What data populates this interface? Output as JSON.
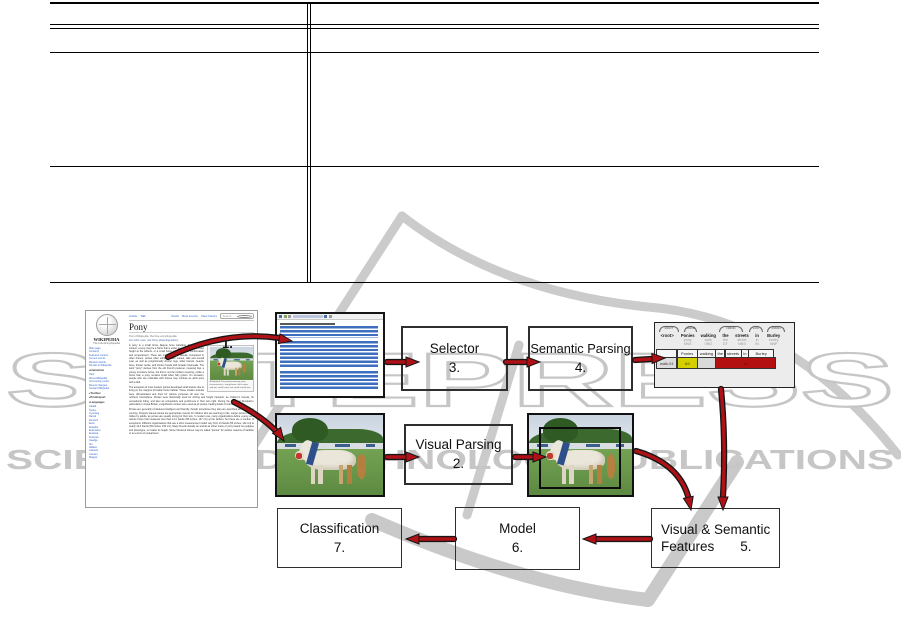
{
  "watermark": {
    "brand": "SCITEPRESS",
    "tagline": "SCIENCE AND TECHNOLOGY PUBLICATIONS"
  },
  "figure": {
    "step1_label": "1.",
    "boxes": {
      "selector": {
        "label": "Selector",
        "num": "3."
      },
      "semantic": {
        "label": "Semantic Parsing",
        "num": "4."
      },
      "visual": {
        "label": "Visual Parsing",
        "num": "2."
      },
      "features": {
        "line1": "Visual & Semantic",
        "line2": "Features",
        "num": "5."
      },
      "model": {
        "label": "Model",
        "num": "6."
      },
      "classification": {
        "label": "Classification",
        "num": "7."
      }
    },
    "wikipedia": {
      "wordmark": "WIKIPEDIA",
      "tagline": "The Free Encyclopedia",
      "tabs_left": [
        "Article",
        "Talk"
      ],
      "tabs_right": [
        "Read",
        "View source",
        "View history"
      ],
      "search": "Search",
      "title": "Pony",
      "from_line": "From Wikipedia, the free encyclopedia",
      "hatnote": "For other uses, see Pony (disambiguation).",
      "sidebar": {
        "group1": [
          "Main page",
          "Contents",
          "Featured content",
          "Current events",
          "Random article",
          "Donate to Wikipedia"
        ],
        "h_interaction": "Interaction",
        "group2": [
          "Help",
          "About Wikipedia",
          "Community portal",
          "Recent changes",
          "Contact Wikipedia"
        ],
        "h_toolbox": "Toolbox",
        "h_print": "Print/export",
        "h_languages": "Languages",
        "group3": [
          "Català",
          "Česky",
          "Cymraeg",
          "Dansk",
          "Deutsch",
          "Eesti",
          "Español",
          "Esperanto",
          "Euskara",
          "Français",
          "Gaeilge",
          "Ido",
          "Italiano",
          "Latviešu",
          "Lietuvių",
          "Magyar"
        ]
      },
      "paragraphs": [
        "A pony is a small horse (Equus ferus caballus). Depending on context, a pony may be a horse that is under an approximate or exact height at the withers, or a small horse with a specific conformation and temperament. There are many different breeds. Compared to other horses, ponies often exhibit thicker manes, tails and overall coat, as well as proportionally shorter legs, wider barrels, heavier bone, thicker necks, and shorter heads with broader foreheads. The word \"pony\" derives from the old French poulenet, meaning foal, a young, immature horse, but this is not the modern meaning; unlike a horse foal, a pony remains small when fully grown. On occasion, people who are unfamiliar with horses may confuse an adult pony with a foal.",
        "The ancestors of most modern ponies developed small stature due to living on the margins of livable horse habitat. These smaller animals were domesticated and bred for various purposes all over the northern hemisphere. Ponies were historically used for driving and freight transport, as children's mounts, for recreational riding, and later as competitors and performers in their own right. During the Industrial Revolution, particularly in Great Britain, a significant number were used as pit ponies, hauling loads of coal in the mines.",
        "Ponies are generally considered intelligent and friendly, though sometimes they also are described as stubborn or cunning. Properly trained ponies are appropriate mounts for children who are learning to ride. Larger ponies can be ridden by adults, as ponies are usually strong for their size. In modern use, many organizations define a pony as a mature horse that measures less than 14.2 hands (58 inches, 147 cm) at the withers, but there are a number of exceptions. Different organizations that use a strict measurement model vary from 14 hands (56 inches, 142 cm) to nearly 14.3 hands (59 inches, 150 cm). Many breeds classify an animal as either horse or pony based on pedigree and phenotype, no matter its height. Some full-sized horses may be called \"ponies\" for various reasons of tradition or as a term of endearment."
      ],
      "thumb_caption": "A Highland Pony demonstrating pony characteristics: sturdy bone, thick mane and tail, small head, and small overall size."
    },
    "parse": {
      "words": [
        "<root>",
        "Ponies",
        "walking",
        "the",
        "streets",
        "in",
        "Burley"
      ],
      "lemmas": [
        "",
        "pony",
        "walk",
        "the",
        "street",
        "in",
        "burley"
      ],
      "pos": [
        "",
        "NNS",
        "VBG",
        "DT",
        "NNS",
        "IN",
        "NNP"
      ],
      "arc_labels": [
        "ROOT",
        "AMOD",
        "NMOD",
        "LOC",
        "PMOD"
      ],
      "srl": {
        "header": [
          "",
          "Ponies",
          "walking",
          "the",
          "streets",
          "in",
          "Burley"
        ],
        "predicate": "walk.01",
        "a0": "A0",
        "a1": "A1"
      }
    },
    "colors": {
      "arrow_red": "#b01116",
      "a0_bg": "#d3cf00",
      "a1_bg": "#b31111",
      "panel_bg": "#ececec",
      "watermark_gray": "#c9c9c9"
    }
  }
}
